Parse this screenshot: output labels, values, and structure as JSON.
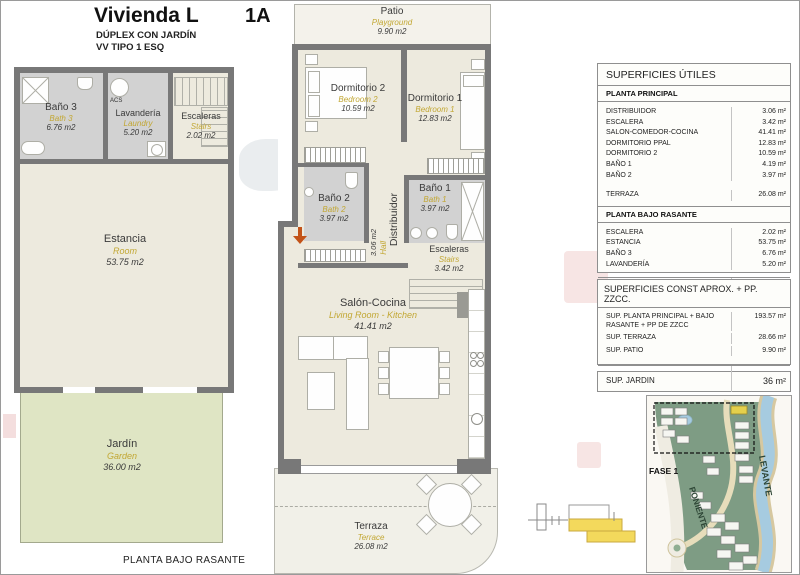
{
  "header": {
    "title": "Vivienda L",
    "unit": "1A",
    "subtitle1": "DÚPLEX CON JARDÍN",
    "subtitle2": "VV TIPO 1 ESQ"
  },
  "lower_plan": {
    "caption": "PLANTA BAJO RASANTE",
    "rooms": {
      "bath3": {
        "name": "Baño 3",
        "en": "Bath 3",
        "area": "6.76 m2"
      },
      "laundry": {
        "name": "Lavandería",
        "en": "Laundry",
        "area": "5.20 m2",
        "acs": "ACS"
      },
      "stairs": {
        "name": "Escaleras",
        "en": "Stairs",
        "area": "2.02 m2"
      },
      "room": {
        "name": "Estancia",
        "en": "Room",
        "area": "53.75 m2"
      },
      "garden": {
        "name": "Jardín",
        "en": "Garden",
        "area": "36.00 m2"
      }
    }
  },
  "main_plan": {
    "rooms": {
      "patio": {
        "name": "Patio",
        "en": "Playground",
        "area": "9.90 m2"
      },
      "bedroom2": {
        "name": "Dormitorio 2",
        "en": "Bedroom 2",
        "area": "10.59 m2"
      },
      "bedroom1": {
        "name": "Dormitorio 1",
        "en": "Bedroom 1",
        "area": "12.83 m2"
      },
      "bath2": {
        "name": "Baño 2",
        "en": "Bath 2",
        "area": "3.97 m2"
      },
      "bath1": {
        "name": "Baño 1",
        "en": "Bath 1",
        "area": "3.97 m2"
      },
      "hall": {
        "name": "Distribuidor",
        "en": "Hall",
        "area": "3.06 m2"
      },
      "stairs": {
        "name": "Escaleras",
        "en": "Stairs",
        "area": "3.42 m2"
      },
      "living": {
        "name": "Salón-Cocina",
        "en": "Living Room - Kitchen",
        "area": "41.41 m2"
      },
      "terrace": {
        "name": "Terraza",
        "en": "Terrace",
        "area": "26.08 m2"
      }
    }
  },
  "tables": {
    "utiles": {
      "title": "SUPERFICIES ÚTILES",
      "principal": {
        "heading": "PLANTA PRINCIPAL",
        "rows": [
          {
            "label": "DISTRIBUIDOR",
            "value": "3.06 m²"
          },
          {
            "label": "ESCALERA",
            "value": "3.42 m²"
          },
          {
            "label": "SALON-COMEDOR-COCINA",
            "value": "41.41 m²"
          },
          {
            "label": "DORMITORIO PPAL",
            "value": "12.83 m²"
          },
          {
            "label": "DORMITORIO 2",
            "value": "10.59 m²"
          },
          {
            "label": "BAÑO 1",
            "value": "4.19 m²"
          },
          {
            "label": "BAÑO 2",
            "value": "3.97 m²"
          }
        ]
      },
      "terraza": {
        "label": "TERRAZA",
        "value": "26.08 m²"
      },
      "bajo": {
        "heading": "PLANTA BAJO RASANTE",
        "rows": [
          {
            "label": "ESCALERA",
            "value": "2.02 m²"
          },
          {
            "label": "ESTANCIA",
            "value": "53.75 m²"
          },
          {
            "label": "BAÑO 3",
            "value": "6.76 m²"
          },
          {
            "label": "LAVANDERÍA",
            "value": "5.20 m²"
          }
        ]
      },
      "total": {
        "label": "TOTAL SUPERFICIE ÚTIL",
        "value": "173.28 m²"
      }
    },
    "const_aprox": {
      "title": "SUPERFICIES CONST APROX. + PP. ZZCC.",
      "rows": [
        {
          "label": "SUP. PLANTA PRINCIPAL + BAJO\nRASANTE + PP DE ZZCC",
          "value": "193.57 m²"
        },
        {
          "label": "SUP. TERRAZA",
          "value": "28.66 m²"
        },
        {
          "label": "SUP. PATIO",
          "value": "9.90 m²"
        }
      ],
      "total": {
        "label": "TOTAL VIV. + TERRAZAS + PATIO+ ZZCC",
        "value": "232.13 m²"
      }
    },
    "jardin": {
      "label": "SUP. JARDIN",
      "value": "36 m²"
    }
  },
  "site_map": {
    "fase": "FASE 1",
    "west": "PONIENTE",
    "east": "LEVANTE"
  },
  "colors": {
    "wall_gray": "#787878",
    "room_beige": "#EDEADE",
    "wet_room_gray": "#D2D2D2",
    "garden_green": "#DFE5C4",
    "accent_yellow": "#C2A733",
    "entrance_arrow_red": "#C35318",
    "map_green": "#7E9C84",
    "river_blue": "#A6CBE0",
    "highlight_yellow": "#E4D04C"
  }
}
